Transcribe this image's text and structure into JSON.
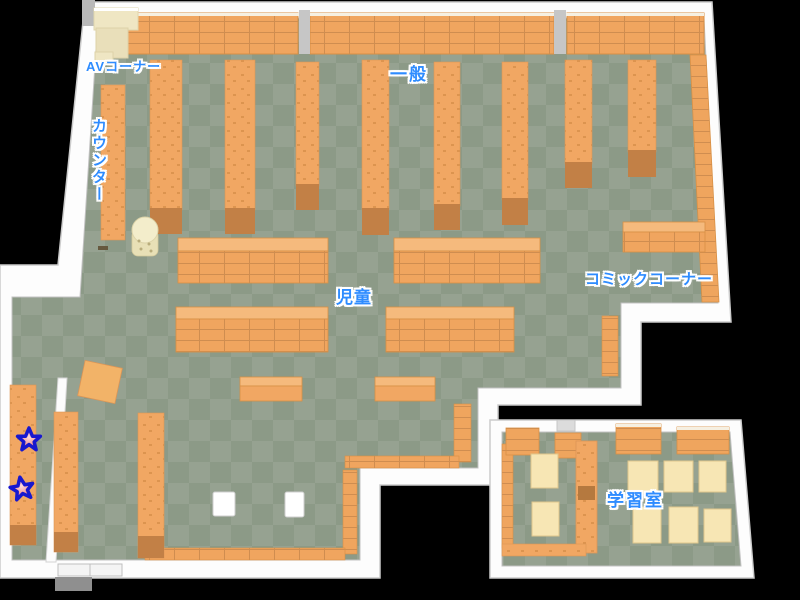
{
  "map": {
    "areas": [
      {
        "id": "av_corner",
        "label": "AVコーナー"
      },
      {
        "id": "counter",
        "label": "カウンター"
      },
      {
        "id": "general",
        "label": "一般"
      },
      {
        "id": "children",
        "label": "児童"
      },
      {
        "id": "comic_corner",
        "label": "コミックコーナー"
      },
      {
        "id": "study_room",
        "label": "学習室"
      }
    ],
    "markers": [
      {
        "type": "star",
        "fill": "#f08c8c",
        "outline": "#1818cf"
      },
      {
        "type": "star",
        "fill": "#f08c8c",
        "outline": "#1818cf"
      }
    ],
    "colors": {
      "background": "#000000",
      "floor_light": "#96a291",
      "floor_dark": "#8c9a87",
      "wall": "#fdfdfd",
      "shelf_orange": "#f1a763",
      "shelf_line": "#cf8d50",
      "shelf_base": "#c28046",
      "furniture_cream": "#efe6c3",
      "desk_cream": "#f7e6b4",
      "label_blue": "#2e8cff"
    }
  }
}
